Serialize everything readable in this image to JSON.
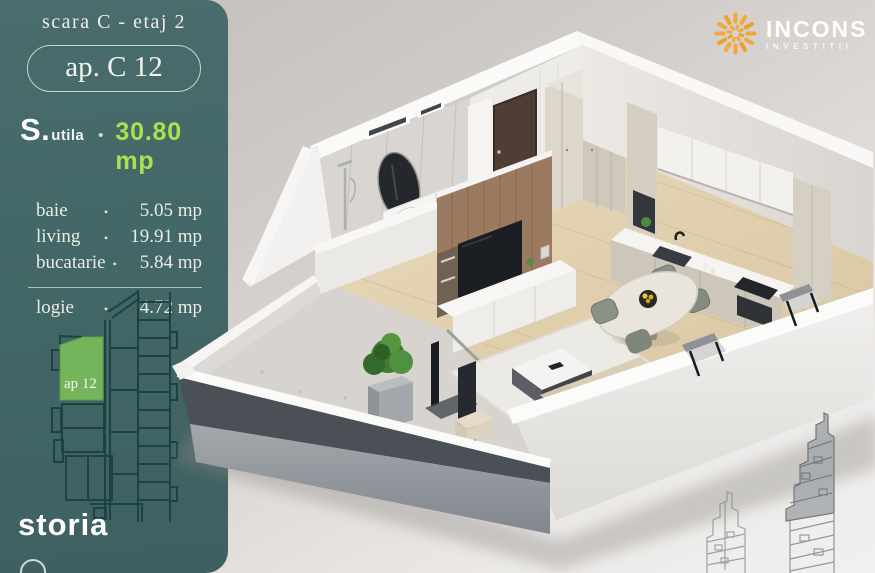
{
  "sidebar": {
    "floor_label": "scara C - etaj 2",
    "apartment_badge": "ap. C 12",
    "area_prefix": "S.",
    "area_sub": "utila",
    "area_bullet": "•",
    "area_value": "30.80 mp",
    "rooms": [
      {
        "name": "baie",
        "bullet": "•",
        "value": "5.05 mp"
      },
      {
        "name": "living",
        "bullet": "•",
        "value": "19.91 mp"
      },
      {
        "name": "bucatarie",
        "bullet": "•",
        "value": "5.84 mp"
      }
    ],
    "logia_room": {
      "name": "logie",
      "bullet": "•",
      "value": "4.72 mp"
    },
    "miniplan_unit_label": "ap 12",
    "brand_logo": "storia"
  },
  "developer_logo": {
    "name": "INCONS",
    "subtitle": "INVESTITII"
  },
  "colors": {
    "sidebar_teal": "#446768",
    "highlight_green": "#abe14e",
    "unit_green": "#74b45a",
    "sun_orange": "#f3a93a",
    "plan_line_teal": "#1c4143"
  }
}
